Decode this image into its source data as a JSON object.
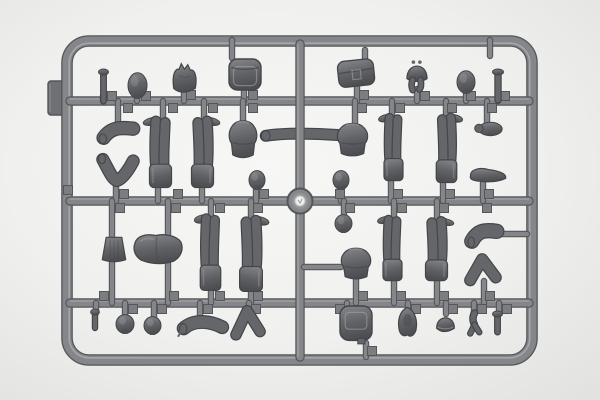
{
  "scene": {
    "width": 600,
    "height": 400,
    "subject": "gray-plastic-model-sprue-with-figure-parts",
    "colors": {
      "bg_center": "#f7f7f5",
      "bg_mid": "#f0f0ee",
      "bg_edge": "#e2e2e0",
      "runner": "#84868a",
      "runner_dark": "#54565a",
      "runner_light": "#b2b4b6",
      "part_fill_top": "#85878b",
      "part_fill_mid": "#606266",
      "part_fill_bottom": "#4c4e52",
      "part_stroke": "#434549",
      "part_limb": "#64666a",
      "part_highlight": "#a7a9ac",
      "gate": "#7b7d80",
      "tab": "#6e7073",
      "hub_ring": "#85878a",
      "hub_center": "#eeeeec"
    }
  },
  "sprue": {
    "frame": {
      "x": 67,
      "y": 41,
      "w": 465,
      "h": 319,
      "rx": 22,
      "t": 9
    },
    "tab": {
      "x": 48,
      "y": 81,
      "w": 17,
      "h": 34,
      "rx": 3
    },
    "hub": {
      "cx": 300,
      "cy": 201,
      "r": 12.5,
      "r_mid": 8,
      "r_inner": 5
    },
    "rails": [
      {
        "x1": 70,
        "y1": 101,
        "x2": 529,
        "y2": 101,
        "t": 7
      },
      {
        "x1": 70,
        "y1": 201,
        "x2": 529,
        "y2": 201,
        "t": 7
      },
      {
        "x1": 70,
        "y1": 303,
        "x2": 529,
        "y2": 303,
        "t": 7
      },
      {
        "x1": 300,
        "y1": 44,
        "x2": 300,
        "y2": 357,
        "t": 7
      }
    ],
    "stubs": [
      [
        232,
        40,
        232,
        58
      ],
      [
        490,
        40,
        490,
        56
      ],
      [
        365,
        50,
        365,
        60
      ],
      [
        103,
        96,
        103,
        101
      ],
      [
        137,
        94,
        137,
        101
      ],
      [
        184,
        92,
        184,
        101
      ],
      [
        244,
        91,
        244,
        101
      ],
      [
        357,
        84,
        357,
        101
      ],
      [
        417,
        89,
        417,
        101
      ],
      [
        466,
        91,
        466,
        101
      ],
      [
        498,
        96,
        498,
        101
      ],
      [
        118,
        101,
        118,
        126
      ],
      [
        163,
        101,
        163,
        119
      ],
      [
        204,
        101,
        204,
        119
      ],
      [
        243,
        101,
        243,
        121
      ],
      [
        355,
        101,
        355,
        124
      ],
      [
        392,
        101,
        392,
        117
      ],
      [
        446,
        101,
        446,
        116
      ],
      [
        487,
        101,
        487,
        124
      ],
      [
        116,
        182,
        116,
        201
      ],
      [
        158,
        186,
        158,
        201
      ],
      [
        202,
        186,
        202,
        201
      ],
      [
        256,
        189,
        256,
        201
      ],
      [
        341,
        189,
        341,
        201
      ],
      [
        391,
        179,
        391,
        201
      ],
      [
        443,
        181,
        443,
        201
      ],
      [
        483,
        183,
        483,
        201
      ],
      [
        112,
        201,
        112,
        238
      ],
      [
        168,
        201,
        168,
        236
      ],
      [
        211,
        201,
        211,
        217
      ],
      [
        251,
        201,
        251,
        219
      ],
      [
        344,
        201,
        344,
        216
      ],
      [
        394,
        201,
        394,
        218
      ],
      [
        437,
        201,
        437,
        220
      ],
      [
        304,
        267,
        341,
        267
      ],
      [
        499,
        234,
        527,
        234
      ],
      [
        112,
        262,
        112,
        303
      ],
      [
        168,
        264,
        168,
        303
      ],
      [
        211,
        290,
        211,
        303
      ],
      [
        251,
        292,
        251,
        303
      ],
      [
        356,
        279,
        356,
        303
      ],
      [
        394,
        280,
        394,
        303
      ],
      [
        437,
        281,
        437,
        303
      ],
      [
        484,
        281,
        484,
        303
      ],
      [
        96,
        303,
        96,
        313
      ],
      [
        125,
        303,
        125,
        317
      ],
      [
        154,
        303,
        154,
        319
      ],
      [
        200,
        303,
        200,
        318
      ],
      [
        249,
        303,
        249,
        311
      ],
      [
        347,
        303,
        347,
        310
      ],
      [
        408,
        303,
        408,
        310
      ],
      [
        446,
        303,
        446,
        314
      ],
      [
        474,
        303,
        474,
        314
      ],
      [
        499,
        303,
        499,
        314
      ],
      [
        366,
        343,
        366,
        357
      ]
    ],
    "gates": [
      [
        112,
        96
      ],
      [
        146,
        96
      ],
      [
        191,
        95
      ],
      [
        253,
        95
      ],
      [
        364,
        95
      ],
      [
        425,
        96
      ],
      [
        471,
        96
      ],
      [
        505,
        96
      ],
      [
        128,
        108
      ],
      [
        173,
        108
      ],
      [
        213,
        108
      ],
      [
        253,
        108
      ],
      [
        362,
        108
      ],
      [
        400,
        108
      ],
      [
        452,
        108
      ],
      [
        492,
        108
      ],
      [
        68,
        190
      ],
      [
        124,
        194
      ],
      [
        178,
        194
      ],
      [
        264,
        194
      ],
      [
        340,
        194
      ],
      [
        398,
        194
      ],
      [
        450,
        194
      ],
      [
        489,
        194
      ],
      [
        120,
        208
      ],
      [
        176,
        208
      ],
      [
        220,
        208
      ],
      [
        258,
        208
      ],
      [
        350,
        208
      ],
      [
        402,
        208
      ],
      [
        444,
        208
      ],
      [
        487,
        208
      ],
      [
        104,
        296
      ],
      [
        174,
        296
      ],
      [
        220,
        296
      ],
      [
        258,
        296
      ],
      [
        363,
        296
      ],
      [
        401,
        296
      ],
      [
        444,
        296
      ],
      [
        490,
        296
      ],
      [
        133,
        309
      ],
      [
        162,
        309
      ],
      [
        208,
        309
      ],
      [
        256,
        309
      ],
      [
        340,
        309
      ],
      [
        416,
        309
      ],
      [
        453,
        309
      ],
      [
        482,
        309
      ],
      [
        507,
        309
      ],
      [
        372,
        351
      ]
    ],
    "parts": [
      {
        "type": "pin",
        "name": "part-pin",
        "x": 99,
        "y": 68,
        "w": 9,
        "h": 34
      },
      {
        "type": "head",
        "name": "part-head",
        "x": 128,
        "y": 72,
        "w": 19,
        "h": 27
      },
      {
        "type": "cap",
        "name": "part-field-cap",
        "x": 171,
        "y": 62,
        "w": 27,
        "h": 33
      },
      {
        "type": "backpack",
        "name": "part-backpack",
        "x": 227,
        "y": 56,
        "w": 36,
        "h": 38
      },
      {
        "type": "satchel",
        "name": "part-satchel-bag",
        "x": 337,
        "y": 57,
        "w": 38,
        "h": 31,
        "rot": -6
      },
      {
        "type": "helmetStraps",
        "name": "part-helmet-with-straps",
        "x": 405,
        "y": 60,
        "w": 24,
        "h": 31
      },
      {
        "type": "head",
        "name": "part-head",
        "x": 457,
        "y": 70,
        "w": 18,
        "h": 24
      },
      {
        "type": "pin",
        "name": "part-pin",
        "x": 493,
        "y": 68,
        "w": 10,
        "h": 33
      },
      {
        "type": "armBent",
        "name": "part-bent-arm",
        "x": 99,
        "y": 121,
        "w": 38,
        "h": 24
      },
      {
        "type": "armV",
        "name": "part-bent-arm",
        "x": 99,
        "y": 155,
        "w": 38,
        "h": 30
      },
      {
        "type": "legs",
        "name": "part-legs-pair",
        "x": 146,
        "y": 116,
        "w": 29,
        "h": 73
      },
      {
        "type": "legs",
        "name": "part-legs-pair",
        "x": 188,
        "y": 116,
        "w": 29,
        "h": 73,
        "flip": true
      },
      {
        "type": "torso",
        "name": "part-torso",
        "x": 227,
        "y": 118,
        "w": 32,
        "h": 41
      },
      {
        "type": "armLong",
        "name": "part-straight-arm",
        "x": 261,
        "y": 127,
        "w": 79,
        "h": 16,
        "layer": "under"
      },
      {
        "type": "torso",
        "name": "part-torso",
        "x": 335,
        "y": 121,
        "w": 35,
        "h": 36
      },
      {
        "type": "legs",
        "name": "part-legs-pair",
        "x": 381,
        "y": 113,
        "w": 25,
        "h": 69
      },
      {
        "type": "legs",
        "name": "part-legs-pair",
        "x": 433,
        "y": 113,
        "w": 27,
        "h": 71,
        "flip": true
      },
      {
        "type": "hand",
        "name": "part-hand",
        "x": 475,
        "y": 121,
        "w": 28,
        "h": 16
      },
      {
        "type": "boot",
        "name": "part-boot",
        "x": 469,
        "y": 165,
        "w": 39,
        "h": 19
      },
      {
        "type": "head",
        "name": "part-head-small",
        "x": 249,
        "y": 170,
        "w": 16,
        "h": 20
      },
      {
        "type": "head",
        "name": "part-head-small",
        "x": 333,
        "y": 170,
        "w": 16,
        "h": 20
      },
      {
        "type": "head",
        "name": "part-head-small",
        "x": 335,
        "y": 214,
        "w": 17,
        "h": 19
      },
      {
        "type": "torsoSkirt",
        "name": "part-greatcoat-skirt",
        "x": 101,
        "y": 235,
        "w": 26,
        "h": 29
      },
      {
        "type": "torsoWide",
        "name": "part-torso-large",
        "x": 132,
        "y": 233,
        "w": 52,
        "h": 32
      },
      {
        "type": "legs",
        "name": "part-legs-pair",
        "x": 197,
        "y": 213,
        "w": 27,
        "h": 79
      },
      {
        "type": "legs",
        "name": "part-legs-pair",
        "x": 236,
        "y": 215,
        "w": 30,
        "h": 78,
        "flip": true
      },
      {
        "type": "torso",
        "name": "part-torso",
        "x": 339,
        "y": 246,
        "w": 34,
        "h": 34
      },
      {
        "type": "legs",
        "name": "part-legs-pair",
        "x": 380,
        "y": 215,
        "w": 25,
        "h": 67
      },
      {
        "type": "legs",
        "name": "part-legs-pair",
        "x": 422,
        "y": 217,
        "w": 29,
        "h": 65,
        "flip": true
      },
      {
        "type": "armBent",
        "name": "part-bent-arm",
        "x": 468,
        "y": 223,
        "w": 32,
        "h": 26
      },
      {
        "type": "fork",
        "name": "part-elbow-arm",
        "x": 466,
        "y": 255,
        "w": 35,
        "h": 28
      },
      {
        "type": "pin",
        "name": "part-pin-small",
        "x": 91,
        "y": 308,
        "w": 8,
        "h": 21
      },
      {
        "type": "head",
        "name": "part-head",
        "x": 116,
        "y": 314,
        "w": 18,
        "h": 20
      },
      {
        "type": "head",
        "name": "part-head",
        "x": 144,
        "y": 316,
        "w": 17,
        "h": 19
      },
      {
        "type": "armCurved",
        "name": "part-curved-arm",
        "x": 178,
        "y": 314,
        "w": 47,
        "h": 24
      },
      {
        "type": "fork",
        "name": "part-elbow-arm",
        "x": 232,
        "y": 306,
        "w": 33,
        "h": 32
      },
      {
        "type": "bag2",
        "name": "part-pack-bag",
        "x": 338,
        "y": 304,
        "w": 36,
        "h": 42
      },
      {
        "type": "hood",
        "name": "part-hood",
        "x": 395,
        "y": 306,
        "w": 25,
        "h": 32
      },
      {
        "type": "helmet",
        "name": "part-helmet",
        "x": 435,
        "y": 311,
        "w": 21,
        "h": 24
      },
      {
        "type": "handClaw",
        "name": "part-hand-small",
        "x": 466,
        "y": 311,
        "w": 17,
        "h": 25
      },
      {
        "type": "pin",
        "name": "part-pin-small",
        "x": 493,
        "y": 310,
        "w": 9,
        "h": 23
      }
    ]
  }
}
